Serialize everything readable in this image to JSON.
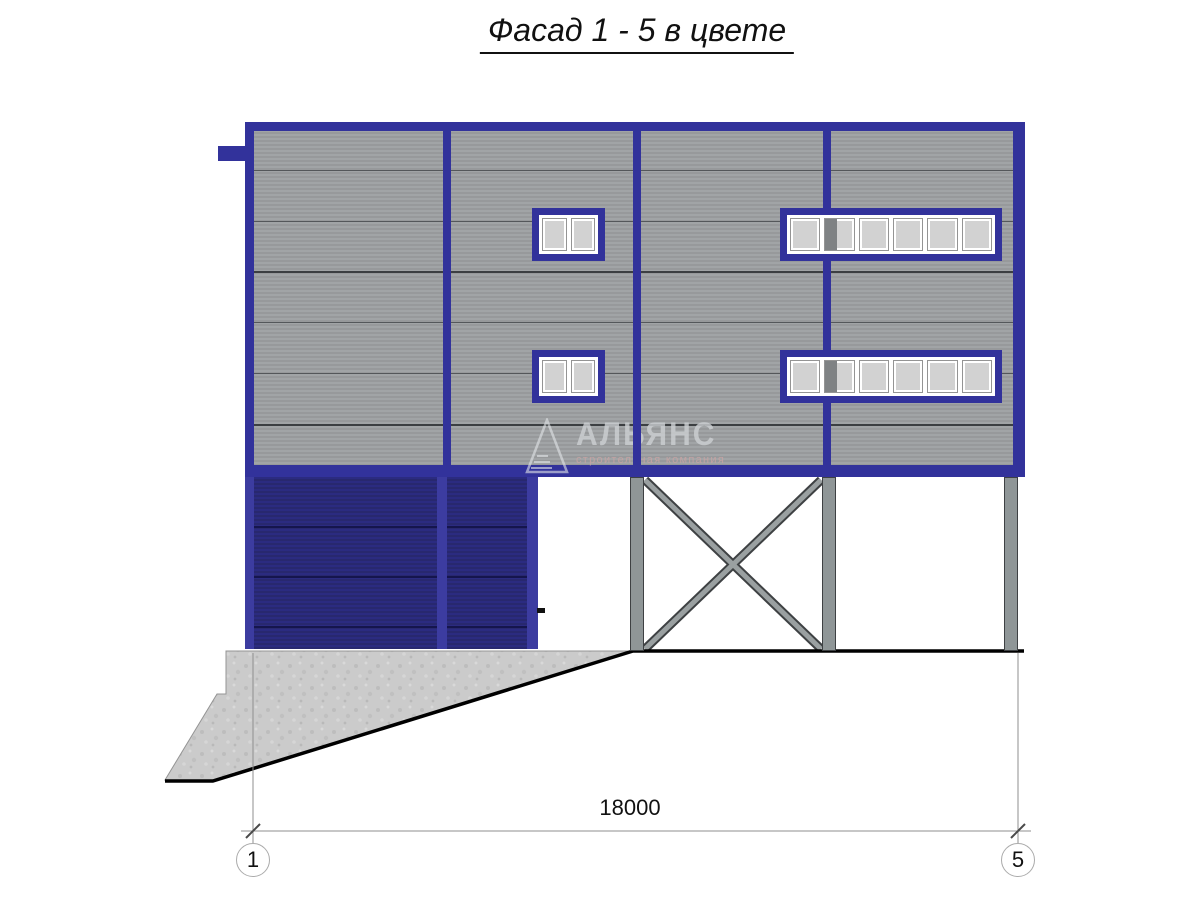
{
  "title": "Фасад 1 - 5 в цвете",
  "watermark": {
    "name": "АЛЬЯНС",
    "subtitle": "строительная компания"
  },
  "dimension_label": "18000",
  "axis_markers": {
    "left": "1",
    "right": "5"
  },
  "colors": {
    "frame_blue": "#32329B",
    "garage_blue": "#2A2A7E",
    "garage_frame_blue": "#3C3CA0",
    "siding_gray": "#9DA0A2",
    "glass_gray": "#D2D2D2",
    "steel_gray": "#8F9697",
    "concrete_gray": "#CBCBCB"
  }
}
